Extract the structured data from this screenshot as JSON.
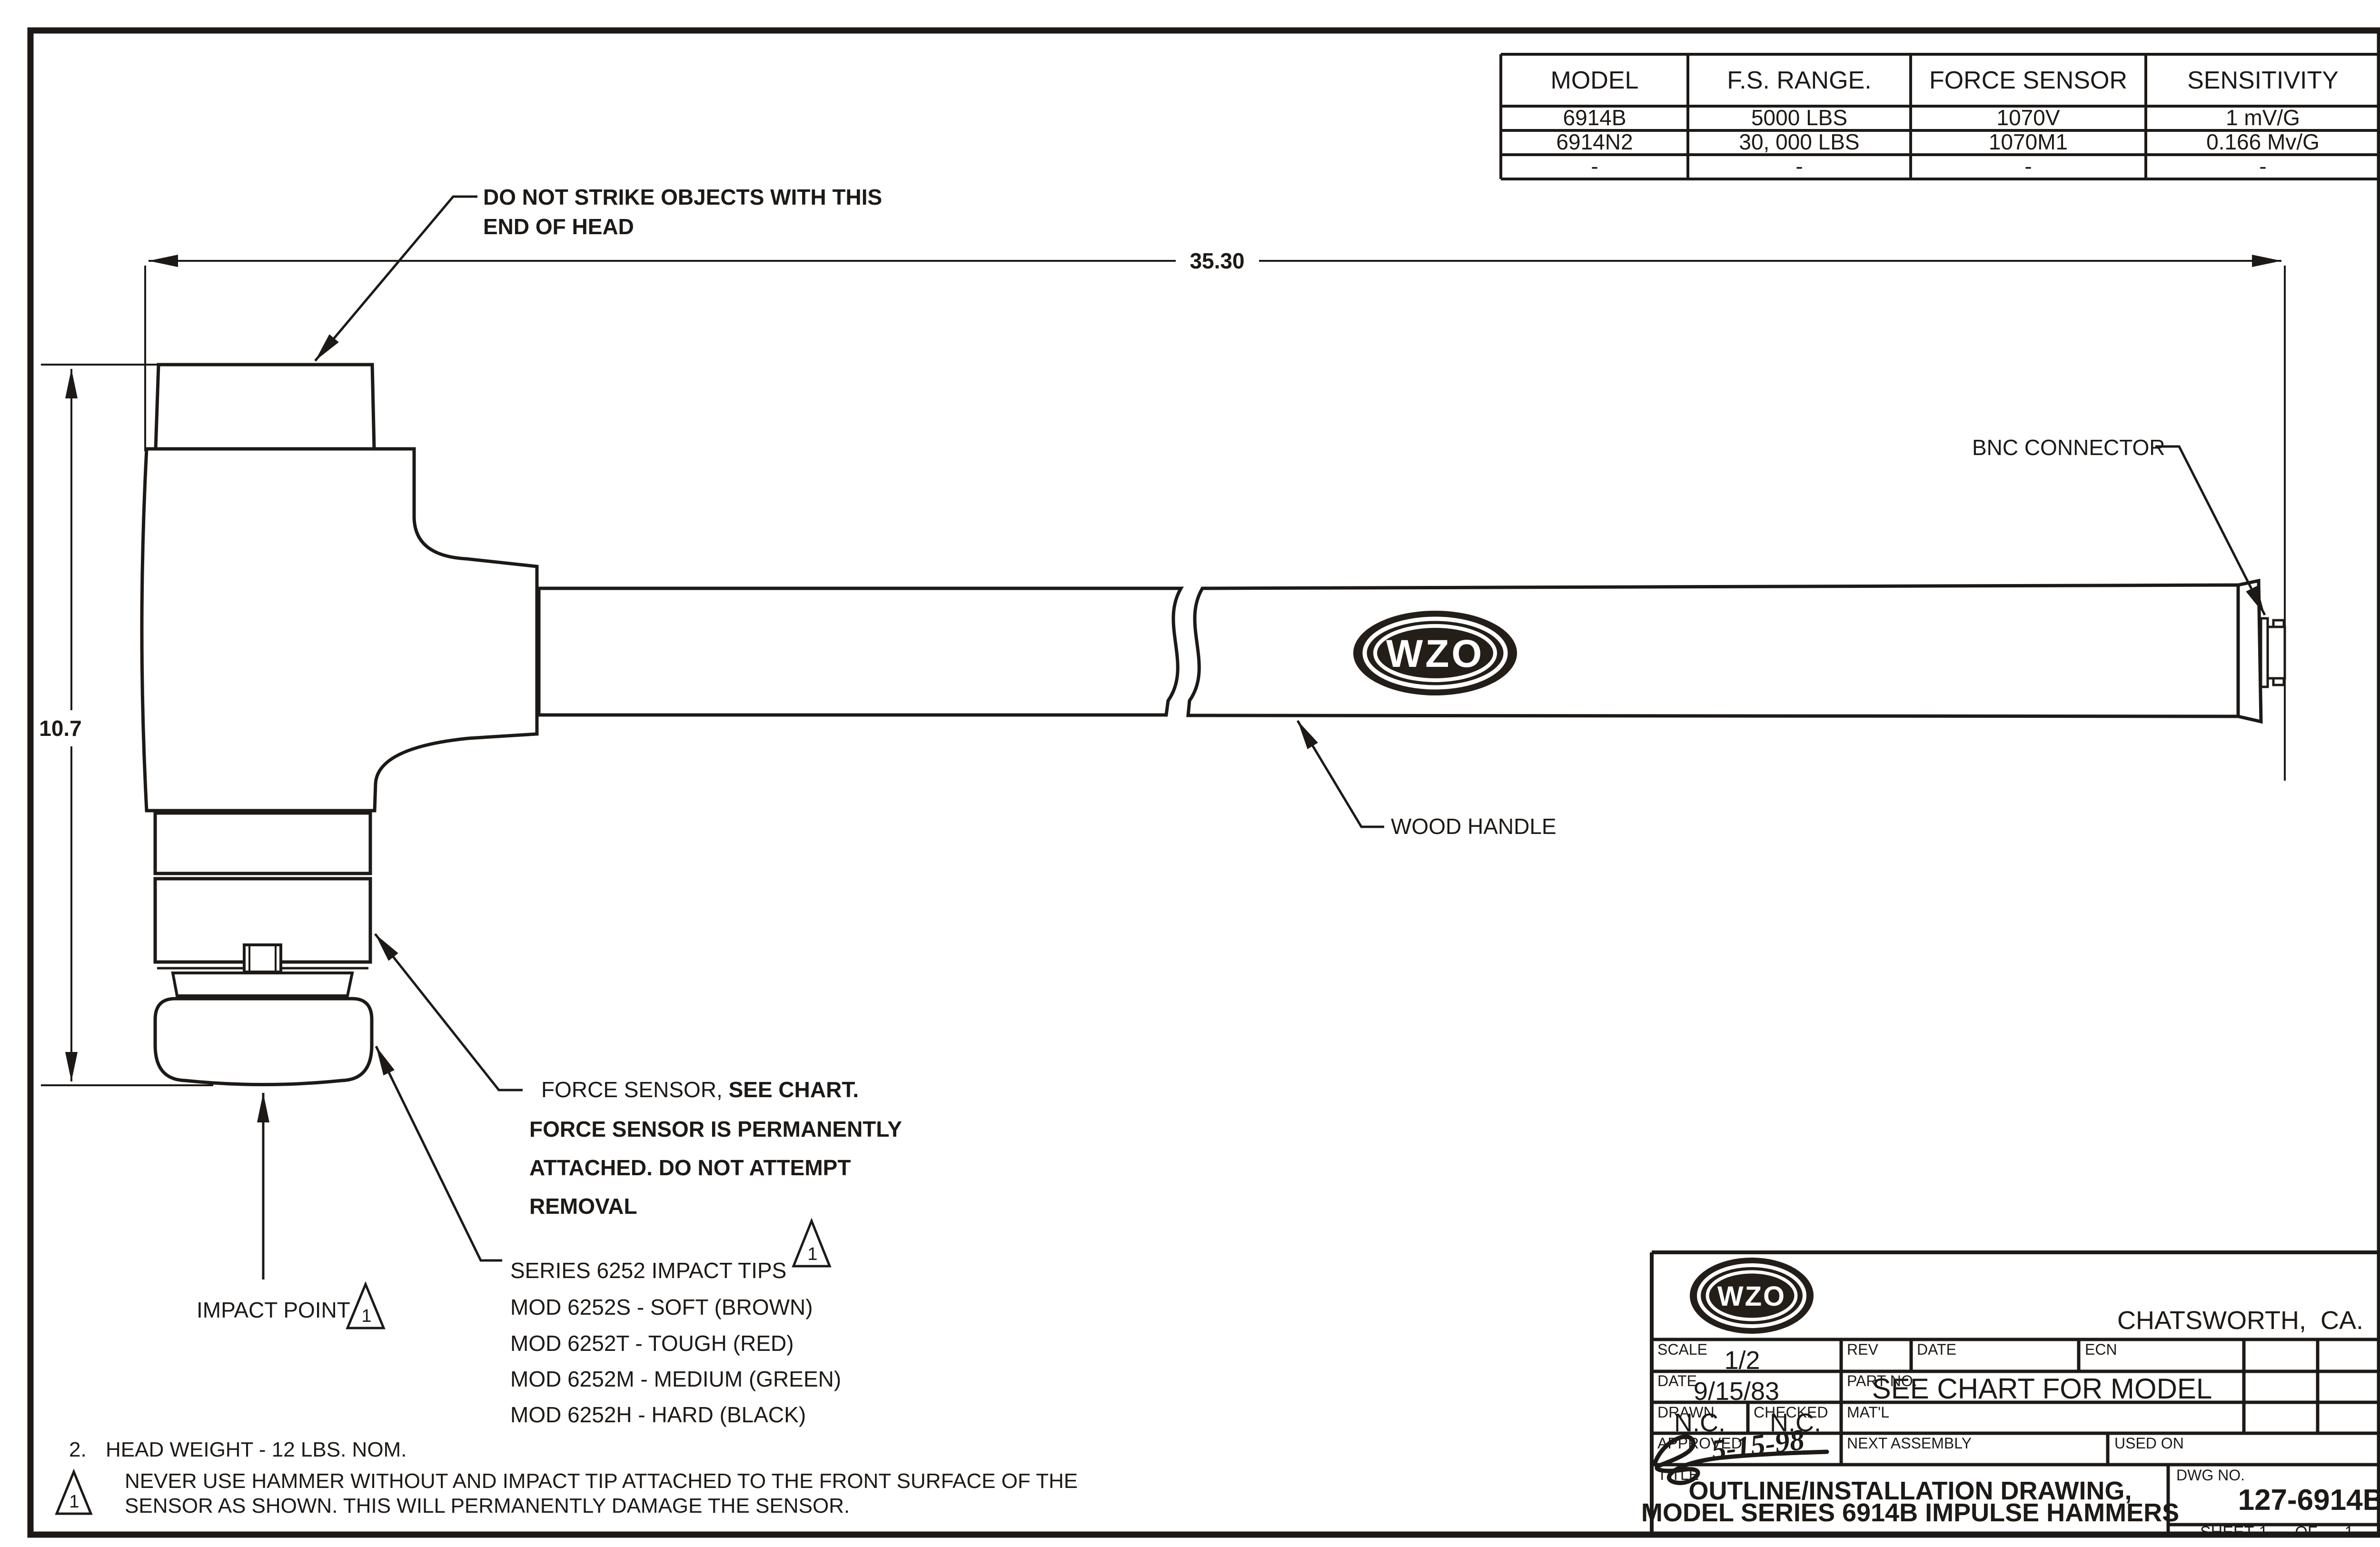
{
  "sheet": {
    "spec_table": {
      "headers": [
        "MODEL",
        "F.S. RANGE.",
        "FORCE SENSOR",
        "SENSITIVITY"
      ],
      "rows": [
        [
          "6914B",
          "5000 LBS",
          "1070V",
          "1 mV/G"
        ],
        [
          "6914N2",
          "30, 000 LBS",
          "1070M1",
          "0.166 Mv/G"
        ],
        [
          "-",
          "-",
          "-",
          "-"
        ]
      ]
    },
    "dimensions": {
      "overall_length": "35.30",
      "head_height": "10.7"
    },
    "callouts": {
      "do_not_strike_line1": "DO NOT STRIKE OBJECTS WITH THIS",
      "do_not_strike_line2": "END OF HEAD",
      "bnc_connector": "BNC CONNECTOR",
      "wood_handle": "WOOD HANDLE",
      "force_sensor_line1a": "FORCE SENSOR, ",
      "force_sensor_line1b": "SEE CHART.",
      "force_sensor_line2": "FORCE SENSOR IS PERMANENTLY",
      "force_sensor_line3": "ATTACHED. DO NOT ATTEMPT",
      "force_sensor_line4": "REMOVAL",
      "impact_tips_line1": "SERIES 6252 IMPACT TIPS",
      "impact_tips_line2": "MOD 6252S - SOFT (BROWN)",
      "impact_tips_line3": "MOD 6252T - TOUGH (RED)",
      "impact_tips_line4": "MOD 6252M - MEDIUM (GREEN)",
      "impact_tips_line5": "MOD 6252H - HARD (BLACK)",
      "impact_point": "IMPACT POINT"
    },
    "flags": {
      "one": "1"
    },
    "notes": {
      "note2_number": "2.",
      "note2_text": "HEAD WEIGHT - 12 LBS. NOM.",
      "note1_line1": "NEVER USE HAMMER WITHOUT AND IMPACT TIP ATTACHED TO THE FRONT SURFACE OF THE",
      "note1_line2": "SENSOR AS SHOWN. THIS WILL PERMANENTLY DAMAGE THE SENSOR."
    },
    "logo": {
      "text": "WZO"
    },
    "title_block": {
      "location": "CHATSWORTH,  CA.",
      "scale_label": "SCALE",
      "scale_value": "1/2",
      "rev_label": "REV",
      "date1_label": "DATE",
      "ecn_label": "ECN",
      "date2_label": "DATE",
      "date_value": "9/15/83",
      "part_no_label": "PART NO.",
      "part_no_value": "SEE CHART FOR MODEL",
      "drawn_label": "DRAWN",
      "drawn_value": "N.C.",
      "checked_label": "CHECKED",
      "checked_value": "N.C.",
      "matl_label": "MAT'L",
      "approved_label": "APPROVED",
      "approved_date": "5-15-98",
      "next_assembly_label": "NEXT ASSEMBLY",
      "used_on_label": "USED ON",
      "title_label": "TITLE",
      "title_line1": "OUTLINE/INSTALLATION DRAWING,",
      "title_line2": "MODEL SERIES 6914B IMPULSE HAMMERS",
      "dwg_no_label": "DWG NO.",
      "dwg_no_value": "127-6914B",
      "sheet_label": "SHEET",
      "sheet_value": "1",
      "of_label": "OF",
      "of_value": "1"
    }
  }
}
